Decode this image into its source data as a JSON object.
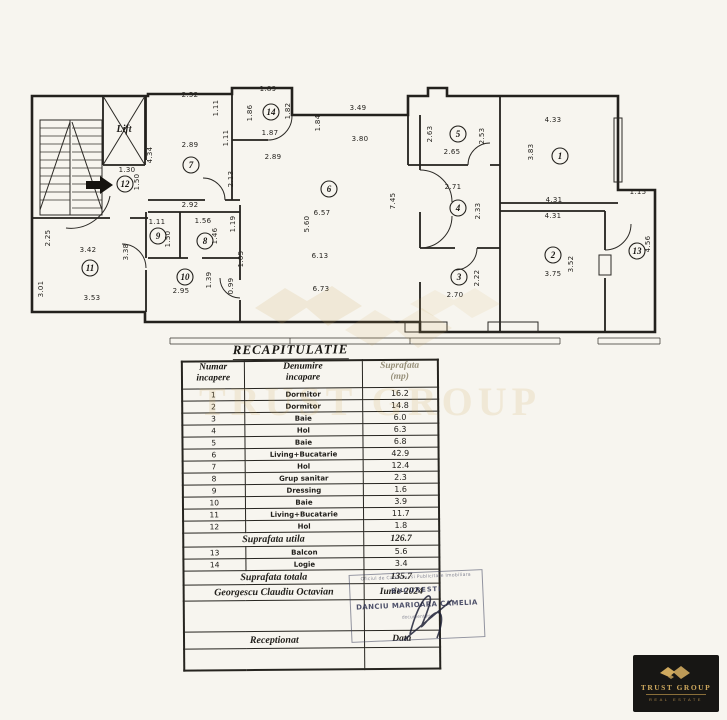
{
  "document": {
    "title": "RECAPITULATIE",
    "watermark_text": "TRUST GROUP"
  },
  "plan": {
    "lift_label": "Lift",
    "rooms": [
      {
        "n": "1",
        "x": 560,
        "y": 156
      },
      {
        "n": "2",
        "x": 553,
        "y": 255
      },
      {
        "n": "3",
        "x": 459,
        "y": 277
      },
      {
        "n": "4",
        "x": 458,
        "y": 208
      },
      {
        "n": "5",
        "x": 458,
        "y": 134
      },
      {
        "n": "6",
        "x": 329,
        "y": 189
      },
      {
        "n": "7",
        "x": 191,
        "y": 165
      },
      {
        "n": "8",
        "x": 205,
        "y": 241
      },
      {
        "n": "9",
        "x": 158,
        "y": 236
      },
      {
        "n": "10",
        "x": 185,
        "y": 277
      },
      {
        "n": "11",
        "x": 90,
        "y": 268
      },
      {
        "n": "12",
        "x": 125,
        "y": 184
      },
      {
        "n": "13",
        "x": 637,
        "y": 251
      },
      {
        "n": "14",
        "x": 271,
        "y": 112
      }
    ],
    "dims": [
      {
        "t": "2.52",
        "x": 190,
        "y": 97
      },
      {
        "t": "2.89",
        "x": 190,
        "y": 147
      },
      {
        "t": "1.30",
        "x": 127,
        "y": 172
      },
      {
        "t": "2.92",
        "x": 190,
        "y": 207
      },
      {
        "t": "1.11",
        "x": 157,
        "y": 224
      },
      {
        "t": "1.56",
        "x": 203,
        "y": 223
      },
      {
        "t": "3.42",
        "x": 88,
        "y": 252
      },
      {
        "t": "3.53",
        "x": 92,
        "y": 300
      },
      {
        "t": "2.95",
        "x": 181,
        "y": 293
      },
      {
        "t": "1.89",
        "x": 268,
        "y": 91
      },
      {
        "t": "1.87",
        "x": 270,
        "y": 135
      },
      {
        "t": "2.89",
        "x": 273,
        "y": 159
      },
      {
        "t": "3.49",
        "x": 358,
        "y": 110
      },
      {
        "t": "3.80",
        "x": 360,
        "y": 141
      },
      {
        "t": "6.57",
        "x": 322,
        "y": 215
      },
      {
        "t": "6.13",
        "x": 320,
        "y": 258
      },
      {
        "t": "6.73",
        "x": 321,
        "y": 291
      },
      {
        "t": "2.65",
        "x": 452,
        "y": 154
      },
      {
        "t": "2.71",
        "x": 453,
        "y": 189
      },
      {
        "t": "2.70",
        "x": 455,
        "y": 297
      },
      {
        "t": "4.33",
        "x": 553,
        "y": 122
      },
      {
        "t": "4.31",
        "x": 554,
        "y": 202
      },
      {
        "t": "4.31",
        "x": 553,
        "y": 218
      },
      {
        "t": "3.75",
        "x": 553,
        "y": 276
      },
      {
        "t": "1.15",
        "x": 638,
        "y": 194
      },
      {
        "t": "1.11",
        "x": 218,
        "y": 108,
        "v": true
      },
      {
        "t": "1.11",
        "x": 228,
        "y": 138,
        "v": true
      },
      {
        "t": "4.34",
        "x": 152,
        "y": 155,
        "v": true
      },
      {
        "t": "1.50",
        "x": 139,
        "y": 182,
        "v": true
      },
      {
        "t": "1.86",
        "x": 252,
        "y": 113,
        "v": true
      },
      {
        "t": "1.82",
        "x": 290,
        "y": 111,
        "v": true
      },
      {
        "t": "1.84",
        "x": 320,
        "y": 123,
        "v": true
      },
      {
        "t": "2.13",
        "x": 233,
        "y": 179,
        "v": true
      },
      {
        "t": "2.25",
        "x": 50,
        "y": 238,
        "v": true
      },
      {
        "t": "3.01",
        "x": 43,
        "y": 289,
        "v": true
      },
      {
        "t": "3.38",
        "x": 128,
        "y": 252,
        "v": true
      },
      {
        "t": "1.50",
        "x": 170,
        "y": 239,
        "v": true
      },
      {
        "t": "1.46",
        "x": 217,
        "y": 236,
        "v": true
      },
      {
        "t": "1.19",
        "x": 235,
        "y": 224,
        "v": true
      },
      {
        "t": "1.05",
        "x": 243,
        "y": 259,
        "v": true
      },
      {
        "t": "0.99",
        "x": 233,
        "y": 286,
        "v": true
      },
      {
        "t": "1.39",
        "x": 211,
        "y": 280,
        "v": true
      },
      {
        "t": "5.60",
        "x": 309,
        "y": 224,
        "v": true
      },
      {
        "t": "7.45",
        "x": 395,
        "y": 201,
        "v": true
      },
      {
        "t": "2.63",
        "x": 432,
        "y": 134,
        "v": true
      },
      {
        "t": "2.53",
        "x": 484,
        "y": 136,
        "v": true
      },
      {
        "t": "2.33",
        "x": 480,
        "y": 211,
        "v": true
      },
      {
        "t": "2.22",
        "x": 479,
        "y": 278,
        "v": true
      },
      {
        "t": "3.83",
        "x": 533,
        "y": 152,
        "v": true
      },
      {
        "t": "3.52",
        "x": 573,
        "y": 264,
        "v": true
      },
      {
        "t": "4.56",
        "x": 650,
        "y": 244,
        "v": true
      }
    ]
  },
  "table": {
    "headers": [
      {
        "l1": "Numar",
        "l2": "incapere"
      },
      {
        "l1": "Denumire",
        "l2": "incapare"
      },
      {
        "l1": "Suprafata",
        "l2": "(mp)"
      }
    ],
    "rows": [
      {
        "n": "1",
        "name": "Dormitor",
        "area": "16.2"
      },
      {
        "n": "2",
        "name": "Dormitor",
        "area": "14.8"
      },
      {
        "n": "3",
        "name": "Baie",
        "area": "6.0"
      },
      {
        "n": "4",
        "name": "Hol",
        "area": "6.3"
      },
      {
        "n": "5",
        "name": "Baie",
        "area": "6.8"
      },
      {
        "n": "6",
        "name": "Living+Bucatarie",
        "area": "42.9"
      },
      {
        "n": "7",
        "name": "Hol",
        "area": "12.4"
      },
      {
        "n": "8",
        "name": "Grup sanitar",
        "area": "2.3"
      },
      {
        "n": "9",
        "name": "Dressing",
        "area": "1.6"
      },
      {
        "n": "10",
        "name": "Baie",
        "area": "3.9"
      },
      {
        "n": "11",
        "name": "Living+Bucatarie",
        "area": "11.7"
      },
      {
        "n": "12",
        "name": "Hol",
        "area": "1.8"
      }
    ],
    "subtotal": {
      "label": "Suprafata utila",
      "value": "126.7"
    },
    "extra_rows": [
      {
        "n": "13",
        "name": "Balcon",
        "area": "5.6"
      },
      {
        "n": "14",
        "name": "Logie",
        "area": "3.4"
      }
    ],
    "total": {
      "label": "Suprafata totala",
      "value": "135.7"
    },
    "signature": {
      "name": "Georgescu Claudiu Octavian",
      "date": "Iunie-2024"
    },
    "reception": {
      "label": "Receptionat",
      "date_label": "Data"
    }
  },
  "stamp": {
    "edge_top": "Oficiul de Cadastru si Publicitate Imobiliara",
    "city": "BUCURESTI",
    "name": "DANCIU MARIOARA CAMELIA",
    "edge_bottom": "documentatia"
  },
  "logo": {
    "title": "TRUST GROUP",
    "subtitle": "REAL ESTATE"
  }
}
